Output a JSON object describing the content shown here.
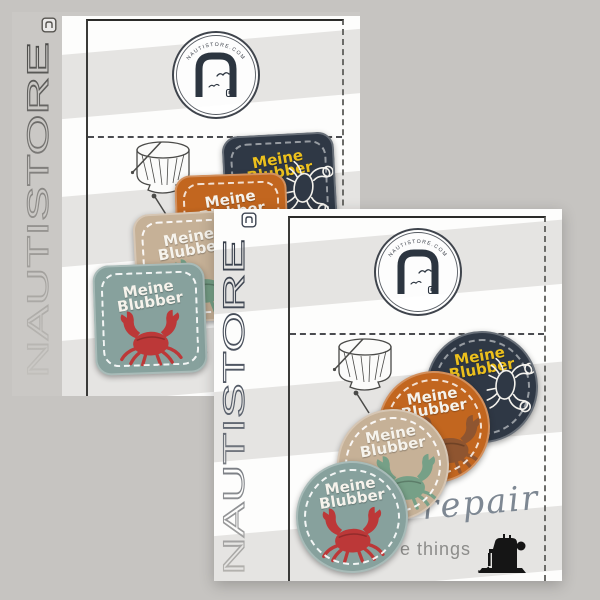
{
  "page": {
    "background_color": "#c6c4c1"
  },
  "brand": {
    "name": "NAUTISTORE",
    "logo_ring_text": "NAUTISTORE.COM"
  },
  "colors": {
    "patch_navy": "#2f3845",
    "patch_orange": "#c2661f",
    "patch_beige": "#c6b197",
    "patch_teal": "#87a19d",
    "text_yellow": "#ecc01d",
    "text_white": "#f6f3ec",
    "crab_red": "#bc3838",
    "crab_brown": "#8f5530",
    "crab_sage": "#76a087",
    "crab_white": "#f3f1ec"
  },
  "cards": [
    {
      "name": "square-patch-card",
      "patch_shape": "square",
      "vertical_brand_text": "NAUTISTORE",
      "script_text": "repair",
      "caption_text": "e things",
      "patches": [
        {
          "fabric": "navy",
          "line1": "Meine",
          "line2": "Blubber",
          "patch_color": "#2f3845",
          "text_color": "#ecc01d",
          "crab_color": "#f3f1ec",
          "stitch_color": "rgba(255,255,255,0.5)"
        },
        {
          "fabric": "orange",
          "line1": "Meine",
          "line2": "Blubber",
          "patch_color": "#c2661f",
          "text_color": "#f6f3ec",
          "crab_color": "#8f5530",
          "stitch_color": "rgba(255,255,255,0.8)"
        },
        {
          "fabric": "beige",
          "line1": "Meine",
          "line2": "Blubber",
          "patch_color": "#c6b197",
          "text_color": "#f6f3ec",
          "crab_color": "#76a087",
          "stitch_color": "rgba(255,255,255,0.9)"
        },
        {
          "fabric": "teal",
          "line1": "Meine",
          "line2": "Blubber",
          "patch_color": "#87a19d",
          "text_color": "#f6f3ec",
          "crab_color": "#bc3838",
          "stitch_color": "rgba(255,255,255,0.9)"
        }
      ]
    },
    {
      "name": "round-patch-card",
      "patch_shape": "round",
      "vertical_brand_text": "NAUTISTORE",
      "script_text": "repair",
      "caption_text": "e things",
      "patches": [
        {
          "fabric": "navy",
          "line1": "Meine",
          "line2": "Blubber",
          "patch_color": "#2f3845",
          "text_color": "#ecc01d",
          "crab_color": "#f3f1ec",
          "stitch_color": "rgba(255,255,255,0.5)"
        },
        {
          "fabric": "orange",
          "line1": "Meine",
          "line2": "Blubber",
          "patch_color": "#c2661f",
          "text_color": "#f6f3ec",
          "crab_color": "#8f5530",
          "stitch_color": "rgba(255,255,255,0.8)"
        },
        {
          "fabric": "beige",
          "line1": "Meine",
          "line2": "Blubber",
          "patch_color": "#c6b197",
          "text_color": "#f6f3ec",
          "crab_color": "#76a087",
          "stitch_color": "rgba(255,255,255,0.9)"
        },
        {
          "fabric": "teal",
          "line1": "Meine",
          "line2": "Blubber",
          "patch_color": "#87a19d",
          "text_color": "#f6f3ec",
          "crab_color": "#bc3838",
          "stitch_color": "rgba(255,255,255,0.9)"
        }
      ]
    }
  ]
}
